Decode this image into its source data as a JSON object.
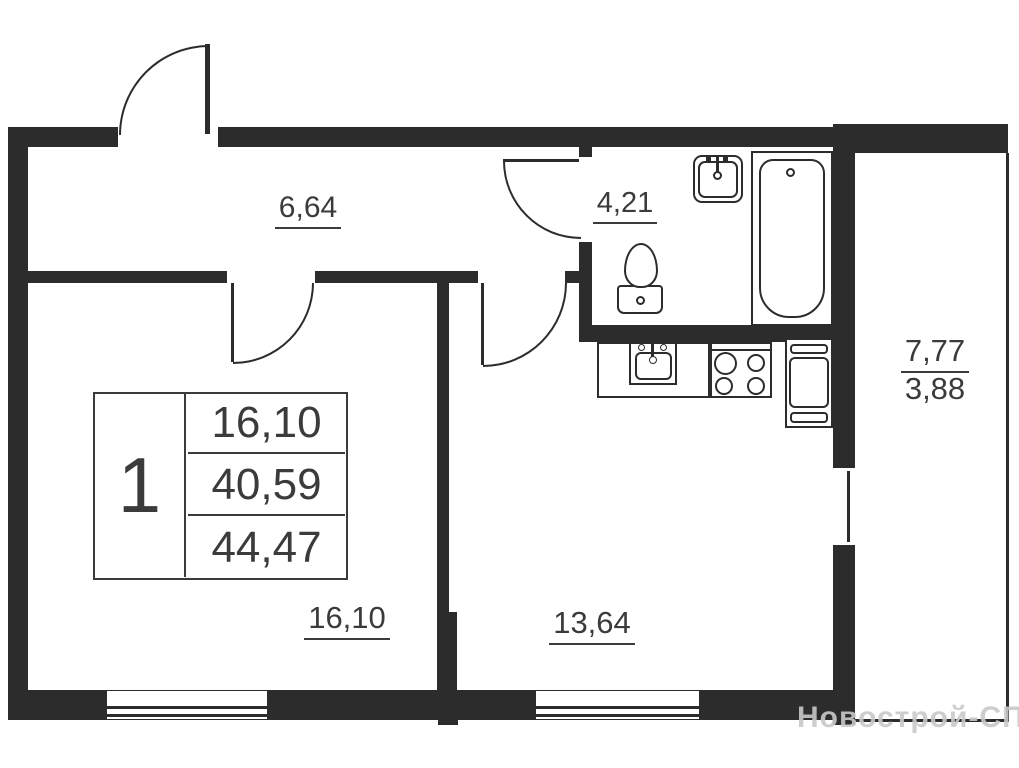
{
  "info_table": {
    "rooms_count": "1",
    "living_area": "16,10",
    "area_without_balcony": "40,59",
    "total_area": "44,47"
  },
  "labels": {
    "hallway": "6,64",
    "bathroom": "4,21",
    "living_room": "16,10",
    "kitchen": "13,64",
    "balcony_full": "7,77",
    "balcony_reduced": "3,88"
  },
  "watermark": "Новострой-СПб",
  "colors": {
    "wall": "#2c2c2c",
    "ink": "#2c2c2c",
    "text": "#3b3b3b",
    "watermark": "#c9c9c9"
  }
}
